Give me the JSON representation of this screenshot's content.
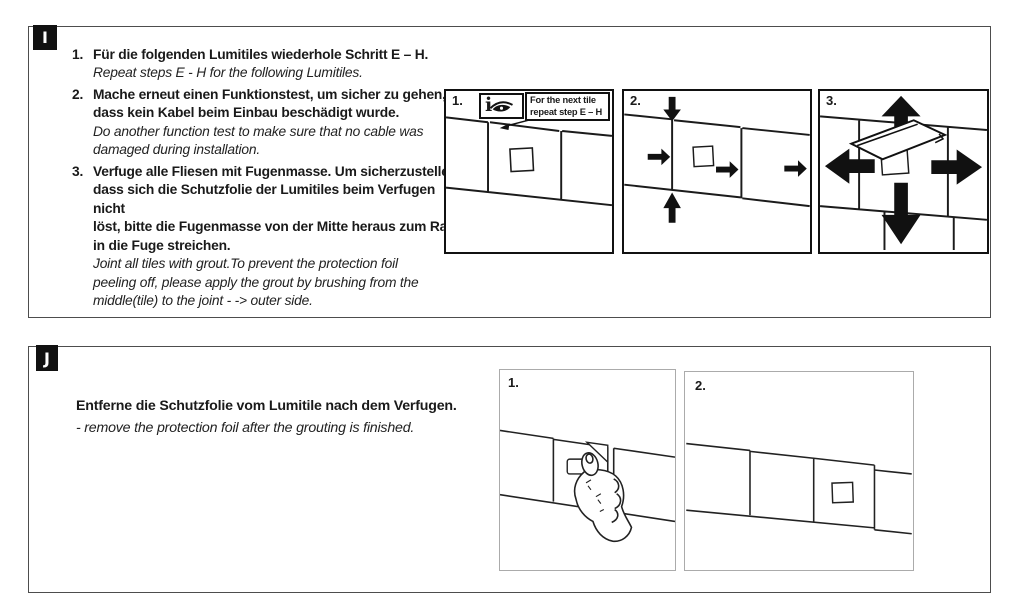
{
  "section_i": {
    "label": "I",
    "steps": [
      {
        "number": "1.",
        "de": "Für die folgenden Lumitiles wiederhole Schritt E – H.",
        "en": "Repeat steps E - H for the following Lumitiles."
      },
      {
        "number": "2.",
        "de": "Mache erneut einen Funktionstest, um sicher zu gehen,\ndass kein Kabel beim Einbau beschädigt wurde.",
        "en": "Do another function test to make sure that no cable was\ndamaged during installation."
      },
      {
        "number": "3.",
        "de": "Verfuge alle Fliesen mit Fugenmasse. Um sicherzustellen,\ndass sich die Schutzfolie der Lumitiles beim Verfugen nicht\nlöst, bitte die Fugenmasse von der Mitte heraus zum Rand\nin die Fuge streichen.",
        "en": "Joint all tiles with grout.To prevent the protection foil\npeeling off, please apply the grout by brushing from the\nmiddle(tile) to the joint -  -> outer side."
      }
    ],
    "panels": [
      {
        "step": "1.",
        "info_glyph": "i",
        "callout": {
          "line1": "For the next tile",
          "line2": "repeat step E – H"
        },
        "icons": [
          "info-icon",
          "eye-icon"
        ]
      },
      {
        "step": "2.",
        "icons": [
          "alignment-arrow-icons"
        ]
      },
      {
        "step": "3.",
        "icons": [
          "block-arrow-icons",
          "grout-trowel-icon"
        ]
      }
    ]
  },
  "section_j": {
    "label": "J",
    "de": "Entferne die Schutzfolie vom Lumitile nach dem Verfugen.",
    "en": "- remove the protection foil after the grouting is finished.",
    "panels": [
      {
        "step": "1.",
        "icons": [
          "hand-peeling-foil-icon"
        ]
      },
      {
        "step": "2.",
        "icons": [
          "lumitile-square-icon"
        ]
      }
    ]
  },
  "colors": {
    "ink": "#1a1a1a",
    "paper": "#ffffff",
    "section_border": "#4d4d4d",
    "panel_border_dark": "#111111",
    "panel_border_light": "#ababab",
    "label_bg": "#111111",
    "label_fg": "#ffffff"
  }
}
